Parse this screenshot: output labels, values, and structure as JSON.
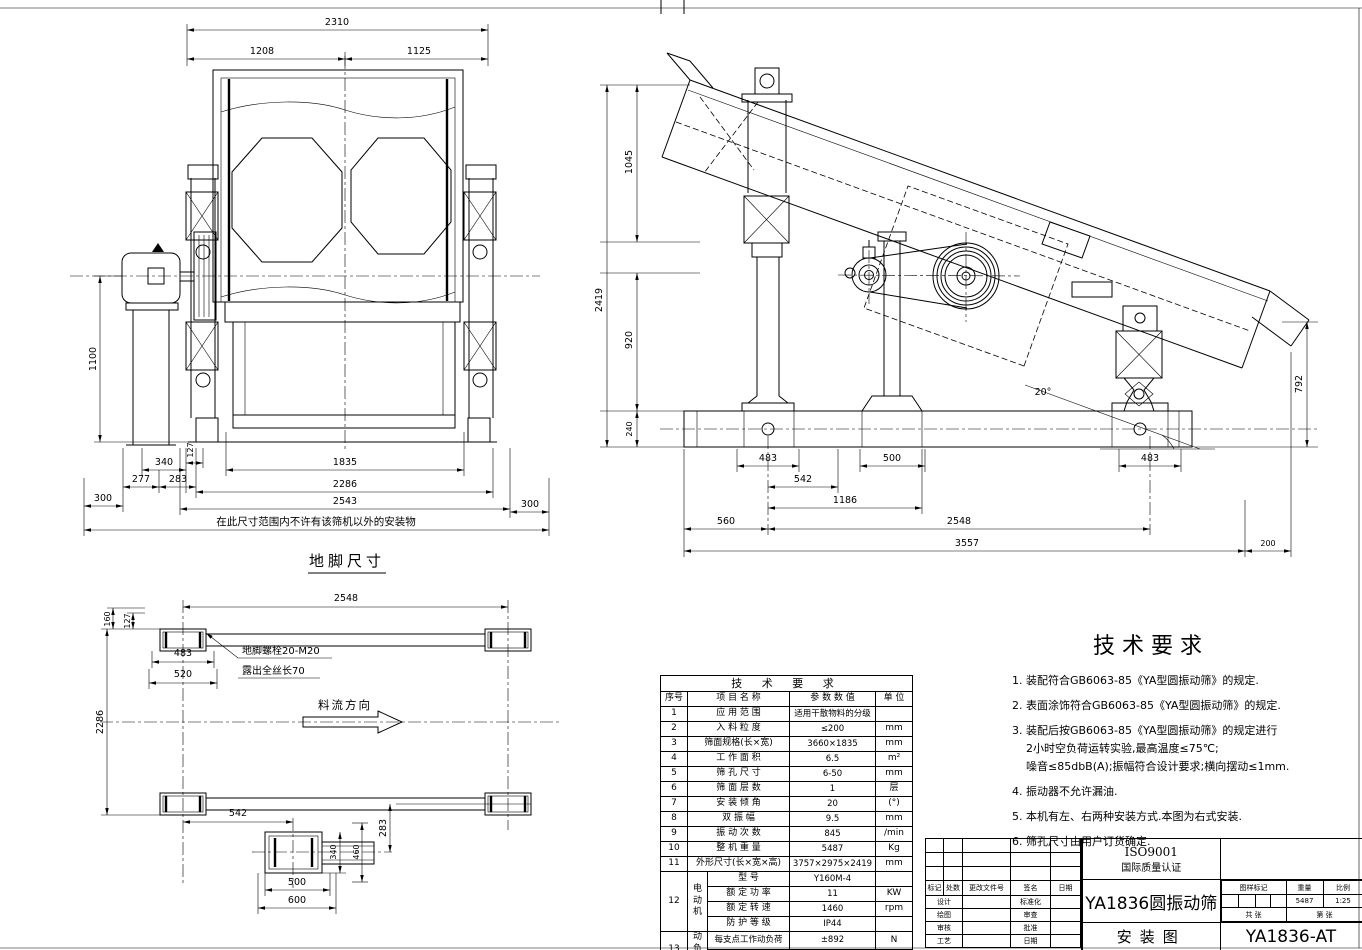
{
  "front_view": {
    "range_note": "在此尺寸范围内不许有该筛机以外的安装物",
    "dims": {
      "overall": "2310",
      "left_half": "1208",
      "right_half": "1125",
      "height": "1100",
      "motor_offset": "340",
      "d127": "127",
      "d277": "277",
      "d283": "283",
      "bolt_span": "1835",
      "width_2286": "2286",
      "width_2543": "2543",
      "clear_left": "300",
      "clear_right": "300"
    }
  },
  "side_view": {
    "dims": {
      "v_top": "1045",
      "v_total": "2419",
      "v_mid": "920",
      "v_base": "240",
      "v_discharge": "792",
      "angle": "20°",
      "foot_left": "483",
      "foot_mid": "500",
      "foot_right": "483",
      "span_542": "542",
      "span_1186": "1186",
      "span_560": "560",
      "span_2548": "2548",
      "span_3557": "3557",
      "span_200": "200"
    }
  },
  "plan_view": {
    "caption": "地脚尺寸",
    "flow_label": "料流方向",
    "bolt_note1": "地脚螺栓20-M20",
    "bolt_note2": "露出全丝长70",
    "dims": {
      "span_2548": "2548",
      "v160": "160",
      "v127": "127",
      "pad_483": "483",
      "pad_520": "520",
      "width_2286": "2286",
      "span_542": "542",
      "offset_283": "283",
      "pad_340": "340",
      "pad_460": "460",
      "pad_500": "500",
      "pad_600": "600"
    }
  },
  "params_table": {
    "title": "技 术 要 求",
    "col_no": "序号",
    "col_name": "项 目 名 称",
    "col_value": "参 数 数 值",
    "col_unit": "单 位",
    "rows": [
      {
        "no": "1",
        "name": "应 用 范 围",
        "value": "适用干散物料的分级",
        "unit": ""
      },
      {
        "no": "2",
        "name": "入 料 粒 度",
        "value": "≤200",
        "unit": "mm"
      },
      {
        "no": "3",
        "name": "筛面规格(长×宽)",
        "value": "3660×1835",
        "unit": "mm"
      },
      {
        "no": "4",
        "name": "工 作 面 积",
        "value": "6.5",
        "unit": "m²"
      },
      {
        "no": "5",
        "name": "筛 孔 尺 寸",
        "value": "6-50",
        "unit": "mm"
      },
      {
        "no": "6",
        "name": "筛 面 层 数",
        "value": "1",
        "unit": "层"
      },
      {
        "no": "7",
        "name": "安 装 倾 角",
        "value": "20",
        "unit": "(°)"
      },
      {
        "no": "8",
        "name": "双 振 幅",
        "value": "9.5",
        "unit": "mm"
      },
      {
        "no": "9",
        "name": "振 动 次 数",
        "value": "845",
        "unit": "/min"
      },
      {
        "no": "10",
        "name": "整 机 重 量",
        "value": "5487",
        "unit": "Kg"
      },
      {
        "no": "11",
        "name": "外形尺寸(长×宽×高)",
        "value": "3757×2975×2419",
        "unit": "mm"
      }
    ],
    "motor": {
      "no": "12",
      "group": "电\n动\n机",
      "rows": [
        {
          "name": "型  号",
          "value": "Y160M-4",
          "unit": ""
        },
        {
          "name": "额 定 功 率",
          "value": "11",
          "unit": "KW"
        },
        {
          "name": "额 定 转 速",
          "value": "1460",
          "unit": "rpm"
        },
        {
          "name": "防 护 等 级",
          "value": "IP44",
          "unit": ""
        }
      ]
    },
    "dyn_load": {
      "no": "13",
      "group": "动\n负\n荷",
      "rows": [
        {
          "name": "每支点工作动负荷",
          "value": "±892",
          "unit": "N"
        },
        {
          "name": "每支点最大动负荷",
          "value": "±4460",
          "unit": "N"
        }
      ]
    }
  },
  "tech_requirements": {
    "title": "技术要求",
    "items": [
      "1. 装配符合GB6063-85《YA型圆振动筛》的规定.",
      "2. 表面涂饰符合GB6063-85《YA型圆振动筛》的规定.",
      "3. 装配后按GB6063-85《YA型圆振动筛》的规定进行",
      "2小时空负荷运转实验,最高温度≤75℃;",
      "噪音≤85dbB(A);振幅符合设计要求;横向摆动≤1mm.",
      "4. 振动器不允许漏油.",
      "5. 本机有左、右两种安装方式.本图为右式安装.",
      "6. 筛孔尺寸由用户订货确定."
    ]
  },
  "title_block": {
    "cert1": "ISO9001",
    "cert2": "国际质量认证",
    "product": "YA1836圆振动筛",
    "sheet_title": "安装图",
    "drawing_no": "YA1836-AT",
    "stage_label": "图样标记",
    "weight_label": "重量",
    "scale_label": "比例",
    "weight": "5487",
    "scale": "1:25",
    "total_label": "共  张",
    "no_label": "第  张",
    "rev": [
      "标记",
      "处数",
      "更改文件号",
      "签名",
      "日期"
    ],
    "sign": [
      [
        "设计",
        "标准化"
      ],
      [
        "绘图",
        "审查"
      ],
      [
        "审核",
        "批准"
      ],
      [
        "工艺",
        "日期"
      ]
    ]
  }
}
